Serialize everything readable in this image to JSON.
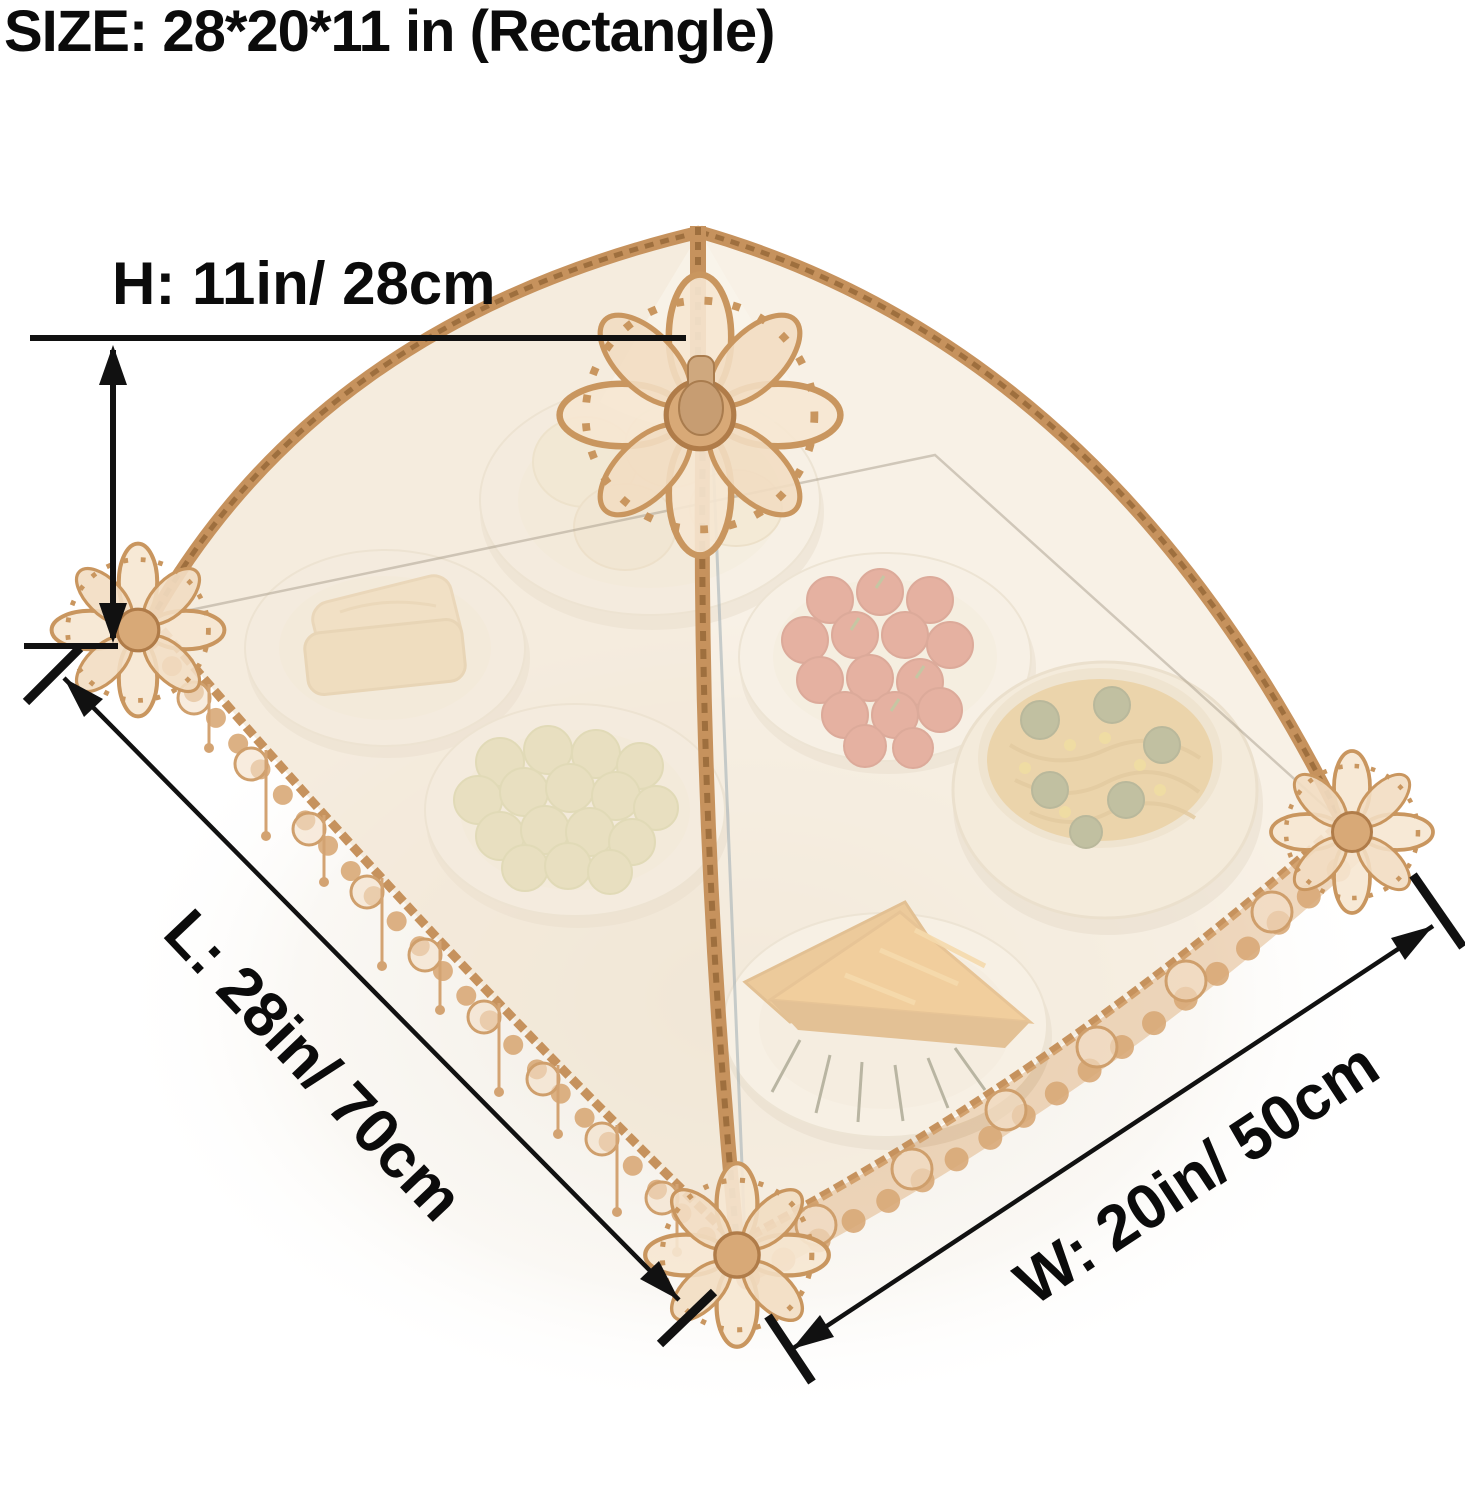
{
  "annotations": {
    "size_title": "SIZE: 28*20*11 in (Rectangle)",
    "height_label": "H: 11in/ 28cm",
    "length_label": "L: 28in/ 70cm",
    "width_label": "W: 20in/ 50cm"
  },
  "product": {
    "type": "pop-up lace mesh food cover tent",
    "shape": "Rectangle",
    "size_in": {
      "length": 28,
      "width": 20,
      "height": 11
    },
    "size_cm": {
      "length": 70,
      "width": 50,
      "height": 28
    },
    "foods_under_cover": [
      "steamed buns plate",
      "bread slices plate",
      "cherry tomatoes plate",
      "green grapes plate",
      "noodle bowl with broccoli and corn",
      "sandwich triangles plate"
    ],
    "colors": {
      "annotation_black": "#111111",
      "lace_gold": "#c6925d",
      "lace_light": "#d8a977",
      "mesh_beige": "#f3e9d8",
      "background": "#ffffff",
      "tomato_red": "#cd584a",
      "grape_green": "#ccd08b",
      "noodle_yellow": "#dcb365",
      "sandwich_orange": "#eda43f"
    }
  }
}
